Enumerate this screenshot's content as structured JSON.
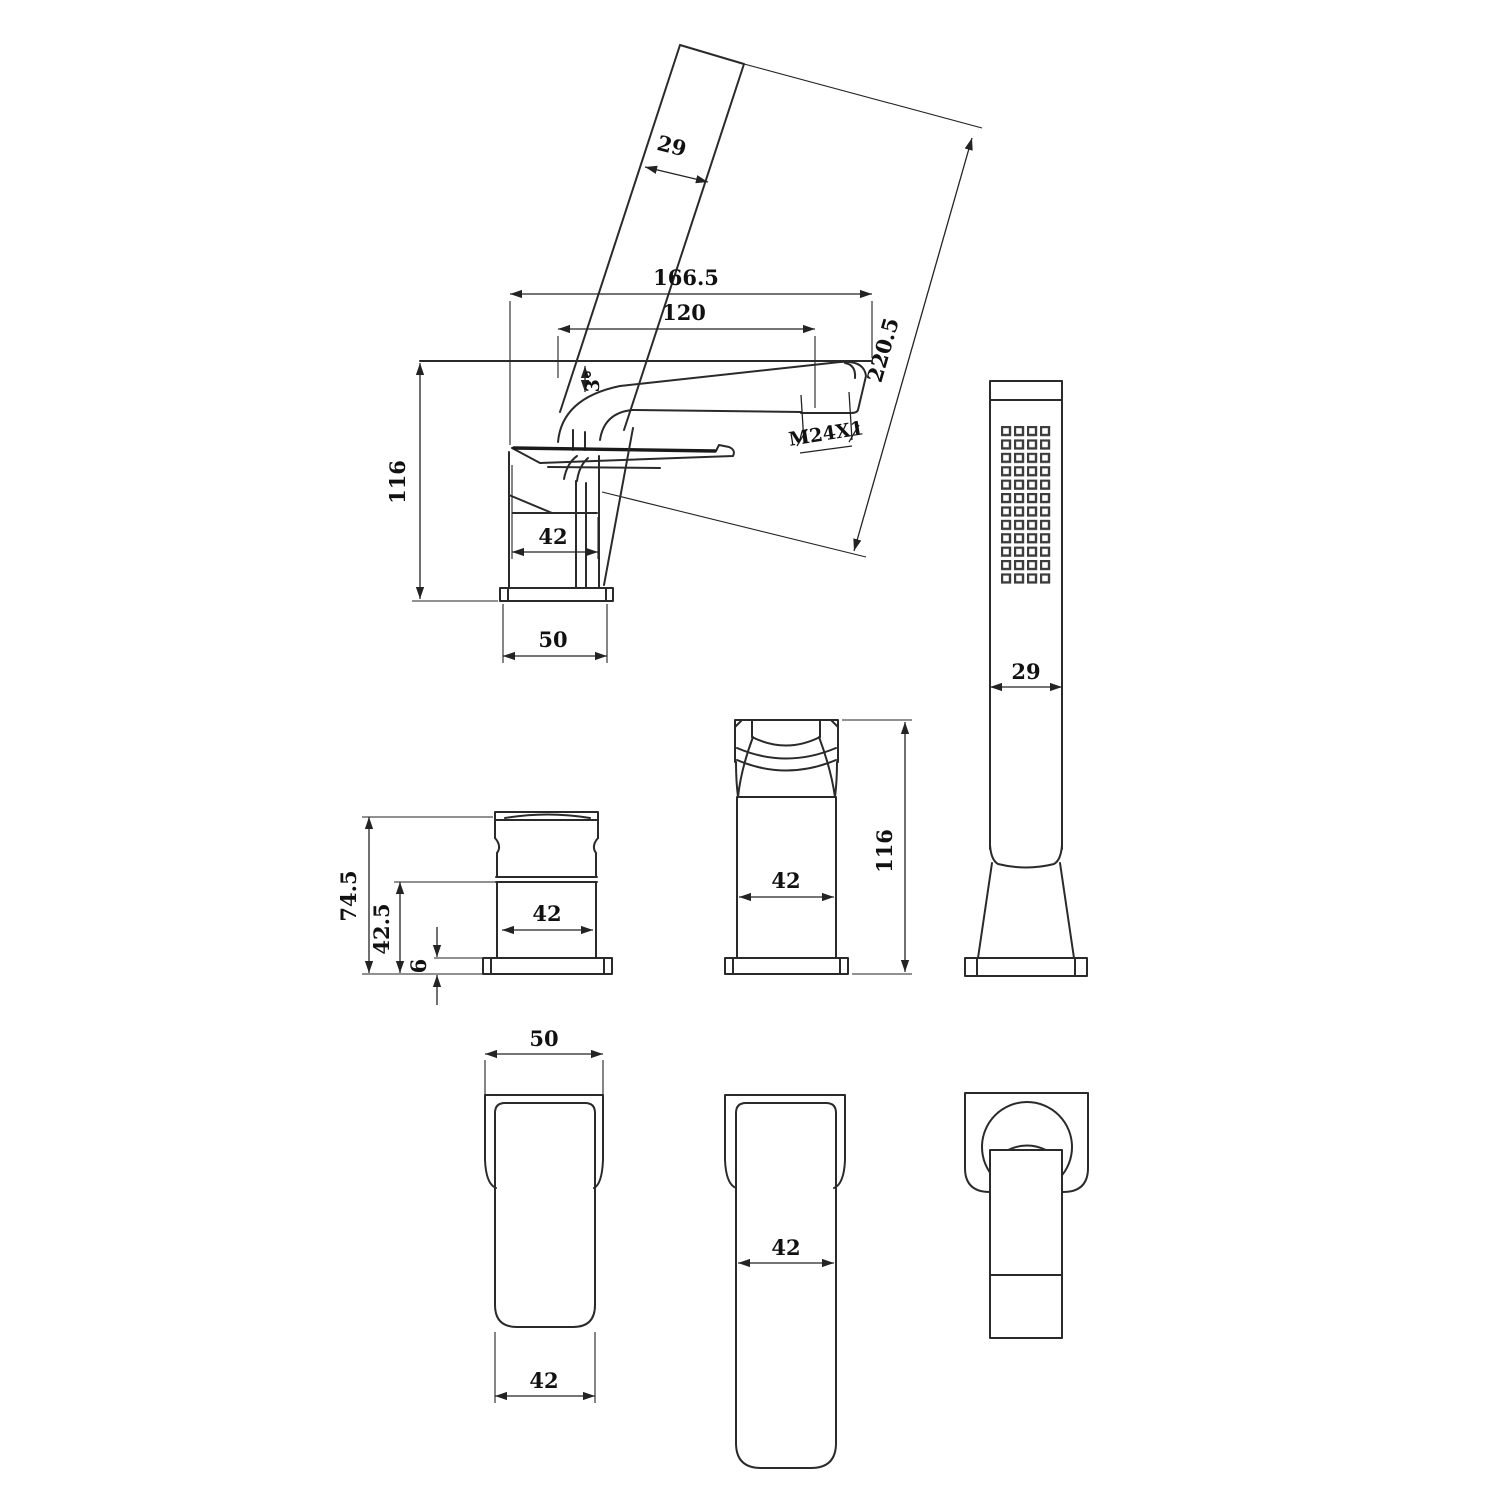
{
  "drawing": {
    "kind": "technical dimension drawing",
    "subject": "bath mixer faucet with hand shower",
    "colors": {
      "line": "#2a2a2a",
      "text": "#111111",
      "nozzle": "#3c3c3c",
      "background": "#ffffff"
    },
    "views": {
      "main_side": {
        "label": "main side view",
        "dims": {
          "hand_shower_width": "29",
          "hand_shower_length": "220.5",
          "overall_length": "166.5",
          "spout_reach": "120",
          "spout_angle": "3°",
          "outlet_thread": "M24X1",
          "height": "116",
          "body_width": "42",
          "base_width": "50"
        }
      },
      "body_side": {
        "label": "valve body side view",
        "dims": {
          "total_height": "74.5",
          "upper_height": "42.5",
          "base_thickness": "6",
          "width": "42"
        }
      },
      "body_front": {
        "label": "faucet front view",
        "dims": {
          "height": "116",
          "width": "42"
        }
      },
      "hand_shower_front": {
        "label": "hand shower front view",
        "dims": {
          "width": "29"
        }
      },
      "base_top": {
        "label": "base top view",
        "dims": {
          "outer_width": "50",
          "inner_width": "42"
        }
      },
      "spout_top": {
        "label": "spout top view",
        "dims": {
          "width": "42"
        }
      },
      "handle_top": {
        "label": "handle top view",
        "dims": {}
      }
    }
  }
}
